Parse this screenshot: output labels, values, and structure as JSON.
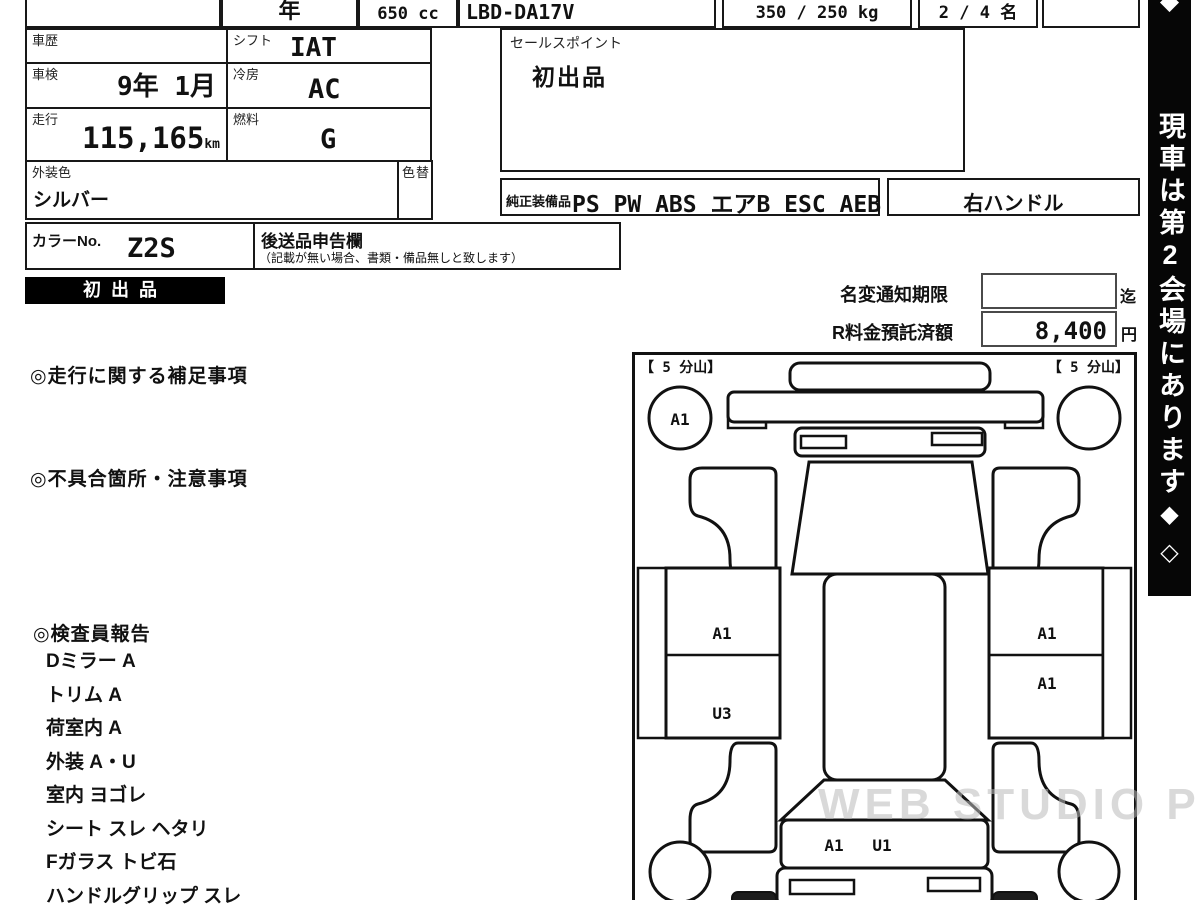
{
  "header": {
    "year_label": "年",
    "displacement": "650 cc",
    "model_code": "LBD-DA17V",
    "weight": "350 / 250 kg",
    "capacity": "2 / 4 名"
  },
  "info": {
    "history_label": "車歴",
    "inspection_label": "車検",
    "inspection_value": "9年 1月",
    "mileage_label": "走行",
    "mileage_value": "115,165",
    "mileage_unit": "km",
    "shift_label": "シフト",
    "shift_value": "IAT",
    "ac_label": "冷房",
    "ac_value": "AC",
    "fuel_label": "燃料",
    "fuel_value": "G",
    "ext_color_label": "外装色",
    "ext_color_value": "シルバー",
    "color_change_label": "色替",
    "color_no_label": "カラーNo.",
    "color_no_value": "Z2S",
    "later_items_label": "後送品申告欄",
    "later_items_note": "（記載が無い場合、書類・備品無しと致します）"
  },
  "sales_point": {
    "label": "セールスポイント",
    "value": "初出品"
  },
  "equipment": {
    "label": "純正装備品",
    "value": "PS PW ABS エアB ESC AEB",
    "steering": "右ハンドル"
  },
  "badge": {
    "text": "初出品"
  },
  "notice": {
    "name_change_label": "名変通知期限",
    "name_change_suffix": "迄",
    "deposit_label": "R料金預託済額",
    "deposit_value": "8,400",
    "deposit_unit": "円"
  },
  "sections": {
    "mileage_note_title": "◎走行に関する補足事項",
    "defects_title": "◎不具合箇所・注意事項",
    "inspector_title": "◎検査員報告",
    "inspector_items": [
      "Dミラー A",
      "トリム A",
      "荷室内 A",
      "外装 A・U",
      "室内 ヨゴレ",
      "シート スレ ヘタリ",
      "Fガラス トビ石",
      "ハンドルグリップ スレ"
    ]
  },
  "diagram": {
    "tire_left": "【 5 分山】",
    "tire_right": "【 5 分山】",
    "front_left_wheel_mark": "A1",
    "left_panel_upper_mark": "A1",
    "left_panel_lower_mark": "U3",
    "right_panel_upper_mark": "A1",
    "right_panel_mid_mark": "A1",
    "rear_gate_mark_1": "A1",
    "rear_gate_mark_2": "U1"
  },
  "banner": {
    "top_diamond": "◆",
    "text": "現車は第2会場にあります",
    "diamond_filled": "◆",
    "diamond_outline": "◇"
  },
  "watermark": "WEB STUDIO PRO"
}
